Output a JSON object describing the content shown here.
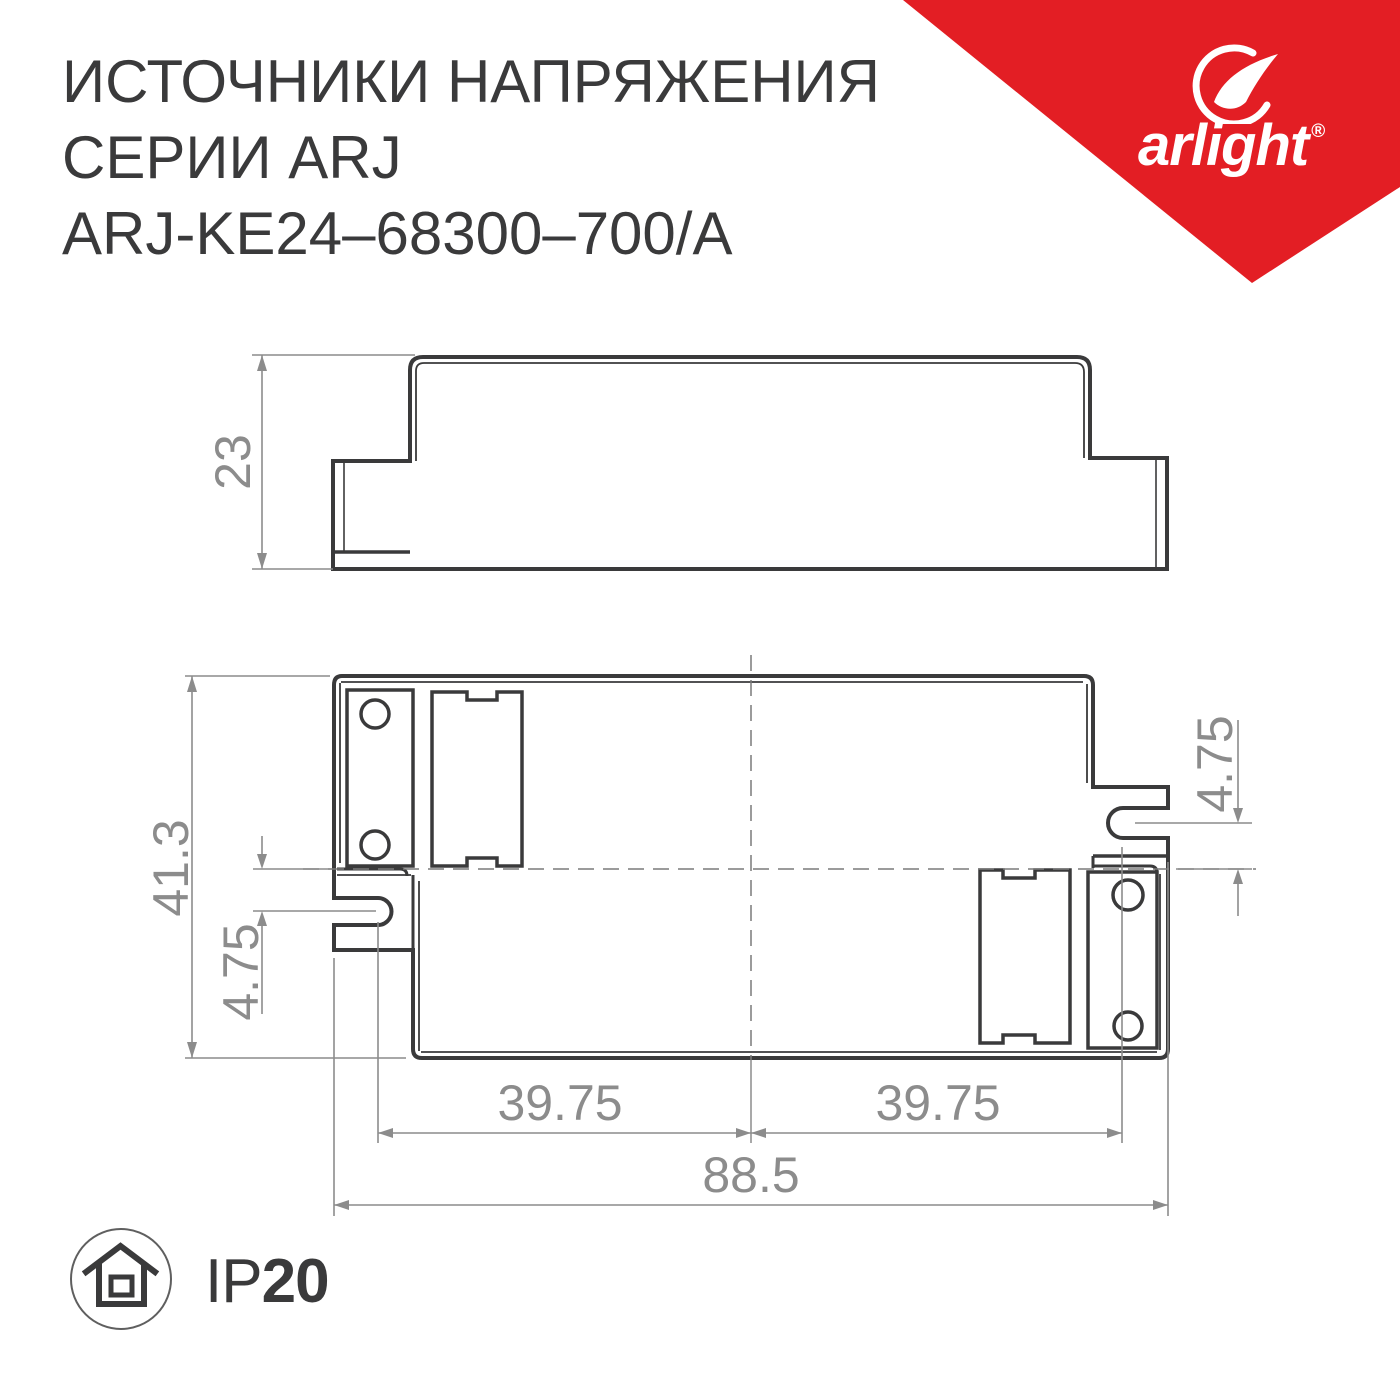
{
  "title": {
    "line1": "ИСТОЧНИКИ НАПРЯЖЕНИЯ",
    "line2": "СЕРИИ ARJ",
    "line3": "ARJ-KE24–68300–700/А"
  },
  "logo": {
    "brand": "arlight",
    "registered": "®"
  },
  "side_view": {
    "height": "23"
  },
  "top_view": {
    "overall_height": "41.3",
    "slot_offset_left": "4.75",
    "slot_offset_right": "4.75",
    "mount_spacing_left": "39.75",
    "mount_spacing_right": "39.75",
    "overall_width": "88.5"
  },
  "protection": {
    "prefix": "IP",
    "rating": "20"
  },
  "colors": {
    "brand_red": "#e31e24",
    "line_dark": "#3a3a3b",
    "dimension_gray": "#8c8c8c",
    "background": "#ffffff"
  }
}
